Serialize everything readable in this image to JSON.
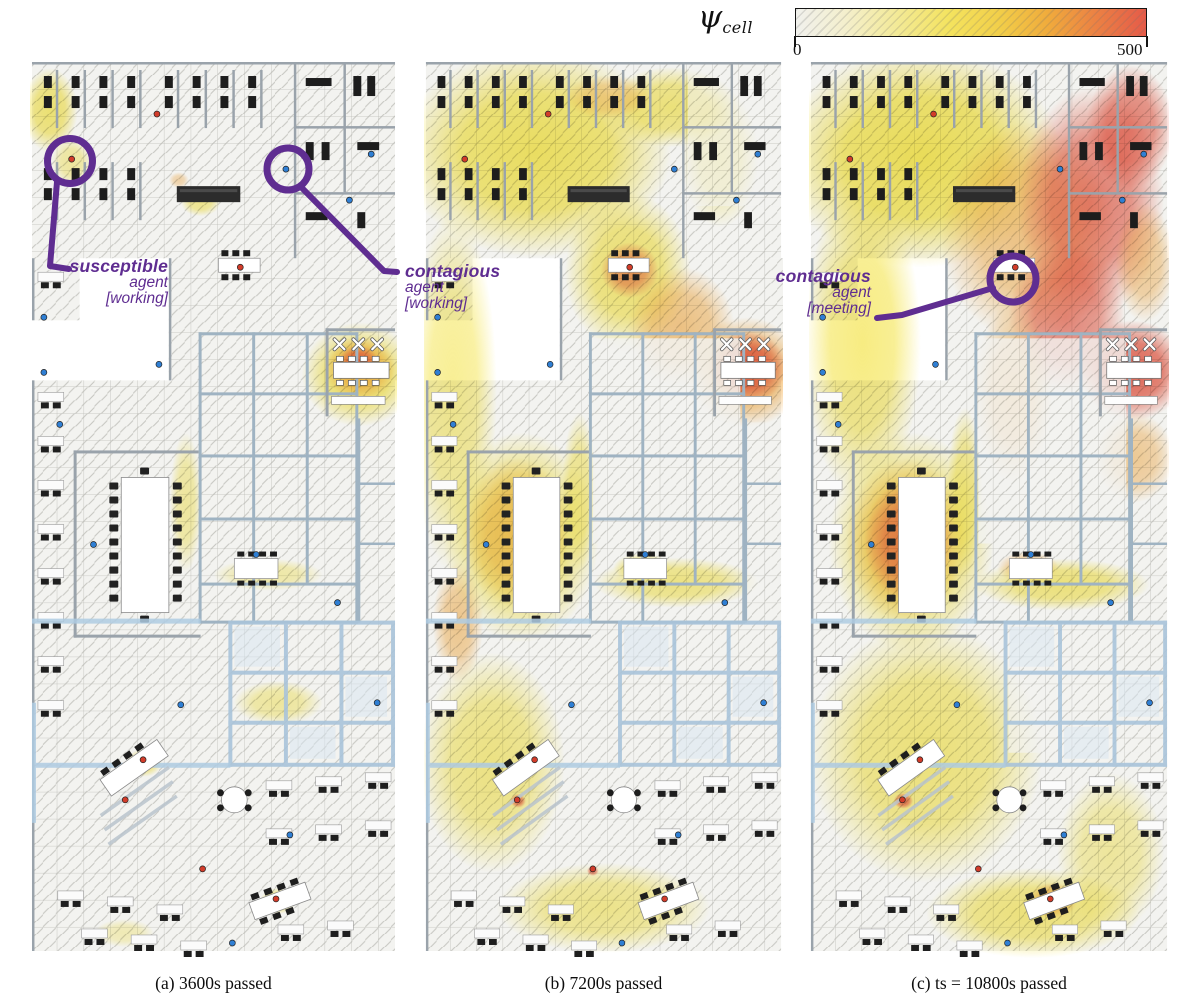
{
  "colorbar": {
    "symbol": "ψ",
    "symbol_subscript": "cell",
    "min_label": "0",
    "max_label": "500",
    "gradient_stops": [
      "#f1f1ed 0%",
      "#f4efcd 14%",
      "#f3ea9a 28%",
      "#f4e35e 44%",
      "#f2cf49 58%",
      "#f0ab3c 72%",
      "#ec8343 85%",
      "#e55b49 100%"
    ]
  },
  "accent_purple": "#5f2d91",
  "annotations": [
    {
      "id": "susceptible-working",
      "lines": [
        "susceptible",
        "agent",
        "[working]"
      ],
      "panel": "a"
    },
    {
      "id": "contagious-working",
      "lines": [
        "contagious",
        "agent",
        "[working]"
      ],
      "panel": "a"
    },
    {
      "id": "contagious-meeting",
      "lines": [
        "contagious",
        "agent",
        "[meeting]"
      ],
      "panel": "c"
    }
  ],
  "chart_data": {
    "type": "heatmap",
    "title": "Cell viral load over office floor plan at three simulation times",
    "colorbar_label": "ψ_cell",
    "colorbar_range": [
      0,
      500
    ],
    "panel_times_s": [
      3600,
      7200,
      10800
    ]
  },
  "palette": {
    "floor": "#f3f3f0",
    "heat_yellow": "#f4e44c",
    "heat_orange": "#f3a73c",
    "heat_red": "#e4503c"
  },
  "panels": [
    {
      "id": "a",
      "caption": "(a) 3600s passed",
      "heat": [
        {
          "x": 20,
          "y": 48,
          "rx": 28,
          "ry": 42,
          "c": "yellow",
          "o": 0.75
        },
        {
          "x": 42,
          "y": 100,
          "rx": 20,
          "ry": 24,
          "c": "yellow",
          "o": 0.5
        },
        {
          "x": 172,
          "y": 140,
          "rx": 20,
          "ry": 14,
          "c": "yellow",
          "o": 0.6
        },
        {
          "x": 150,
          "y": 118,
          "rx": 10,
          "ry": 8,
          "c": "orange",
          "o": 0.4
        },
        {
          "x": 332,
          "y": 312,
          "rx": 58,
          "ry": 52,
          "c": "yellow",
          "o": 0.8
        },
        {
          "x": 333,
          "y": 306,
          "rx": 36,
          "ry": 32,
          "c": "orange",
          "o": 0.8
        },
        {
          "x": 331,
          "y": 300,
          "rx": 20,
          "ry": 17,
          "c": "red",
          "o": 0.75
        },
        {
          "x": 157,
          "y": 440,
          "rx": 16,
          "ry": 70,
          "c": "yellow",
          "o": 0.5
        },
        {
          "x": 240,
          "y": 512,
          "rx": 55,
          "ry": 16,
          "c": "yellow",
          "o": 0.45
        },
        {
          "x": 250,
          "y": 640,
          "rx": 45,
          "ry": 22,
          "c": "yellow",
          "o": 0.5
        },
        {
          "x": 115,
          "y": 700,
          "rx": 18,
          "ry": 14,
          "c": "yellow",
          "o": 0.7
        },
        {
          "x": 113,
          "y": 699,
          "rx": 7,
          "ry": 6,
          "c": "red",
          "o": 0.7
        },
        {
          "x": 250,
          "y": 838,
          "rx": 18,
          "ry": 13,
          "c": "yellow",
          "o": 0.75
        },
        {
          "x": 247,
          "y": 835,
          "rx": 6,
          "ry": 5,
          "c": "red",
          "o": 0.6
        },
        {
          "x": 95,
          "y": 870,
          "rx": 30,
          "ry": 14,
          "c": "yellow",
          "o": 0.35
        }
      ],
      "cold": []
    },
    {
      "id": "b",
      "caption": "(b) 7200s passed",
      "heat": [
        {
          "x": 115,
          "y": 90,
          "rx": 140,
          "ry": 105,
          "c": "yellow",
          "o": 0.85
        },
        {
          "x": 255,
          "y": 45,
          "rx": 70,
          "ry": 40,
          "c": "yellow",
          "o": 0.7
        },
        {
          "x": 190,
          "y": 35,
          "rx": 45,
          "ry": 22,
          "c": "orange",
          "o": 0.45
        },
        {
          "x": 305,
          "y": 95,
          "rx": 40,
          "ry": 70,
          "c": "yellow",
          "o": 0.4
        },
        {
          "x": 30,
          "y": 330,
          "rx": 45,
          "ry": 180,
          "c": "yellow",
          "o": 0.6
        },
        {
          "x": 35,
          "y": 560,
          "rx": 26,
          "ry": 60,
          "c": "orange",
          "o": 0.55
        },
        {
          "x": 100,
          "y": 475,
          "rx": 80,
          "ry": 105,
          "c": "yellow",
          "o": 0.8
        },
        {
          "x": 95,
          "y": 470,
          "rx": 55,
          "ry": 75,
          "c": "orange",
          "o": 0.55
        },
        {
          "x": 210,
          "y": 210,
          "rx": 65,
          "ry": 80,
          "c": "yellow",
          "o": 0.75
        },
        {
          "x": 212,
          "y": 208,
          "rx": 30,
          "ry": 28,
          "c": "red",
          "o": 0.55
        },
        {
          "x": 265,
          "y": 265,
          "rx": 55,
          "ry": 60,
          "c": "orange",
          "o": 0.6
        },
        {
          "x": 332,
          "y": 310,
          "rx": 60,
          "ry": 55,
          "c": "orange",
          "o": 0.8
        },
        {
          "x": 333,
          "y": 305,
          "rx": 40,
          "ry": 36,
          "c": "red",
          "o": 0.85
        },
        {
          "x": 160,
          "y": 430,
          "rx": 18,
          "ry": 80,
          "c": "yellow",
          "o": 0.6
        },
        {
          "x": 260,
          "y": 520,
          "rx": 85,
          "ry": 25,
          "c": "yellow",
          "o": 0.65
        },
        {
          "x": 225,
          "y": 505,
          "rx": 30,
          "ry": 14,
          "c": "yellow",
          "o": 0.7
        },
        {
          "x": 70,
          "y": 700,
          "rx": 75,
          "ry": 110,
          "c": "yellow",
          "o": 0.65
        },
        {
          "x": 115,
          "y": 698,
          "rx": 10,
          "ry": 8,
          "c": "red",
          "o": 0.75
        },
        {
          "x": 97,
          "y": 738,
          "rx": 8,
          "ry": 7,
          "c": "red",
          "o": 0.7
        },
        {
          "x": 185,
          "y": 845,
          "rx": 110,
          "ry": 45,
          "c": "yellow",
          "o": 0.6
        },
        {
          "x": 174,
          "y": 808,
          "rx": 6,
          "ry": 5,
          "c": "red",
          "o": 0.7
        },
        {
          "x": 250,
          "y": 838,
          "rx": 16,
          "ry": 11,
          "c": "yellow",
          "o": 0.6
        }
      ],
      "cold": [
        {
          "x": 174,
          "y": 276,
          "w": 152,
          "h": 205,
          "o": 0.85
        },
        {
          "x": 205,
          "y": 562,
          "w": 160,
          "h": 125,
          "o": 0.8
        },
        {
          "x": 272,
          "y": 4,
          "w": 94,
          "h": 140,
          "o": 0.55
        },
        {
          "x": 332,
          "y": 360,
          "w": 34,
          "h": 180,
          "o": 0.6
        }
      ]
    },
    {
      "id": "c",
      "caption": "(c) ts = 10800s  passed",
      "heat": [
        {
          "x": 115,
          "y": 95,
          "rx": 145,
          "ry": 110,
          "c": "yellow",
          "o": 0.9
        },
        {
          "x": 55,
          "y": 280,
          "rx": 60,
          "ry": 160,
          "c": "yellow",
          "o": 0.7
        },
        {
          "x": 225,
          "y": 170,
          "rx": 90,
          "ry": 110,
          "c": "orange",
          "o": 0.6
        },
        {
          "x": 290,
          "y": 140,
          "rx": 75,
          "ry": 115,
          "c": "red",
          "o": 0.7
        },
        {
          "x": 265,
          "y": 255,
          "rx": 60,
          "ry": 75,
          "c": "red",
          "o": 0.65
        },
        {
          "x": 330,
          "y": 65,
          "rx": 45,
          "ry": 62,
          "c": "red",
          "o": 0.7
        },
        {
          "x": 345,
          "y": 200,
          "rx": 30,
          "ry": 60,
          "c": "orange",
          "o": 0.5
        },
        {
          "x": 333,
          "y": 308,
          "rx": 55,
          "ry": 50,
          "c": "red",
          "o": 0.85
        },
        {
          "x": 335,
          "y": 395,
          "rx": 40,
          "ry": 45,
          "c": "orange",
          "o": 0.5
        },
        {
          "x": 210,
          "y": 330,
          "rx": 40,
          "ry": 90,
          "c": "orange",
          "o": 0.55
        },
        {
          "x": 105,
          "y": 480,
          "rx": 85,
          "ry": 110,
          "c": "yellow",
          "o": 0.8
        },
        {
          "x": 100,
          "y": 478,
          "rx": 62,
          "ry": 82,
          "c": "orange",
          "o": 0.6
        },
        {
          "x": 102,
          "y": 478,
          "rx": 45,
          "ry": 60,
          "c": "red",
          "o": 0.6
        },
        {
          "x": 225,
          "y": 505,
          "rx": 32,
          "ry": 16,
          "c": "orange",
          "o": 0.6
        },
        {
          "x": 260,
          "y": 522,
          "rx": 90,
          "ry": 26,
          "c": "yellow",
          "o": 0.7
        },
        {
          "x": 160,
          "y": 430,
          "rx": 18,
          "ry": 85,
          "c": "yellow",
          "o": 0.65
        },
        {
          "x": 120,
          "y": 690,
          "rx": 120,
          "ry": 130,
          "c": "yellow",
          "o": 0.7
        },
        {
          "x": 115,
          "y": 698,
          "rx": 13,
          "ry": 10,
          "c": "red",
          "o": 0.8
        },
        {
          "x": 97,
          "y": 738,
          "rx": 10,
          "ry": 8,
          "c": "red",
          "o": 0.75
        },
        {
          "x": 250,
          "y": 838,
          "rx": 26,
          "ry": 18,
          "c": "red",
          "o": 0.8
        },
        {
          "x": 230,
          "y": 850,
          "rx": 110,
          "ry": 45,
          "c": "yellow",
          "o": 0.7
        },
        {
          "x": 310,
          "y": 790,
          "rx": 55,
          "ry": 80,
          "c": "yellow",
          "o": 0.5
        }
      ],
      "cold": [
        {
          "x": 174,
          "y": 276,
          "w": 152,
          "h": 205,
          "o": 0.8
        },
        {
          "x": 205,
          "y": 580,
          "w": 160,
          "h": 110,
          "o": 0.7
        }
      ]
    }
  ]
}
